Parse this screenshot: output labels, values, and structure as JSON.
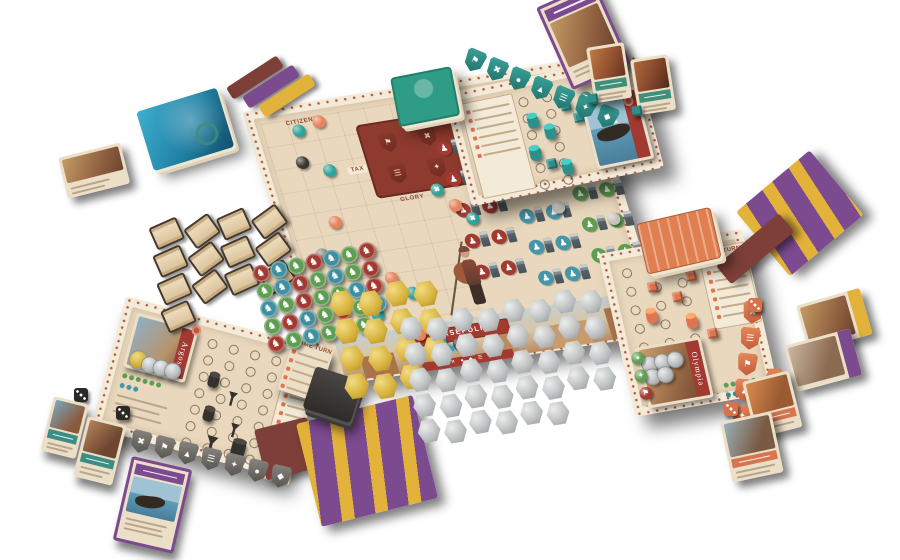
{
  "palette": {
    "bg": "#ffffff",
    "tan": "#e9d8bd",
    "frame": "#f3ead7",
    "motif": "#b0543a",
    "panel_red": "#8e3a2e",
    "red": "#a23a31",
    "blue": "#4596a8",
    "green": "#5f9e52",
    "teal": "#2f8f8a",
    "orange": "#e0764f",
    "dark": "#35312d",
    "gray": "#7e7a75",
    "silver": "#bcbfc0",
    "gold": "#d7b23c",
    "purple": "#7b4a8f",
    "yellow": "#e3b23a",
    "maroon": "#7d3f37",
    "parch": "#ecdfc8",
    "deck_green": "#2f9c85",
    "deck_blue": "#1f7fa3",
    "deck_orange": "#e08050",
    "deck_dark": "#3a3734",
    "ink": "#8a4a34",
    "line": "#c3ab8a",
    "ribbon": "#5d6b72"
  },
  "icons": {
    "horse": "♞",
    "award": "♟"
  },
  "main_board": {
    "labels": {
      "citizens": "CITIZENS",
      "tax": "TAX",
      "glory": "GLORY",
      "troops": "TROOPS"
    },
    "city": {
      "name": "PERSEPOLIS",
      "strip_icons": "✕ ● ◆ ☰",
      "slots": [
        {
          "c": "#a23a31"
        },
        {
          "c": "#4596a8"
        },
        {
          "c": "#5f9e52"
        }
      ]
    },
    "shield_panel": [
      {
        "g": "⚑"
      },
      {
        "g": "✖"
      },
      {
        "g": "▲"
      },
      {
        "g": "☰"
      },
      {
        "g": "✦"
      },
      {
        "g": "●"
      }
    ],
    "awards": {
      "red": {
        "cells": 12,
        "style": "--c:#a23a31"
      },
      "blue": {
        "cells": 12,
        "style": "--c:#4596a8"
      },
      "green": {
        "cells": 10,
        "style": "--c:#5f9e52"
      }
    },
    "track_tokens": [
      {
        "x": 34,
        "y": 12,
        "c": "#2fa39a"
      },
      {
        "x": 56,
        "y": 6,
        "c": "#e8825c"
      },
      {
        "x": 28,
        "y": 44,
        "c": "#3b3734"
      },
      {
        "x": 52,
        "y": 56,
        "c": "#2fa39a"
      },
      {
        "x": 42,
        "y": 108,
        "c": "#e8825c"
      },
      {
        "x": 20,
        "y": 138,
        "c": "#8e8a85"
      },
      {
        "x": 62,
        "y": 160,
        "c": "#3b3734"
      },
      {
        "x": 80,
        "y": 172,
        "c": "#e8825c"
      },
      {
        "x": 96,
        "y": 190,
        "c": "#2fa39a"
      },
      {
        "x": 56,
        "y": 206,
        "c": "#2fa39a"
      },
      {
        "x": 74,
        "y": 218,
        "c": "#3b3734"
      },
      {
        "x": 90,
        "y": 232,
        "c": "#e8825c"
      },
      {
        "x": 108,
        "y": 242,
        "c": "#2fa39a"
      },
      {
        "x": 126,
        "y": 248,
        "c": "#3b3734"
      },
      {
        "x": 150,
        "y": 92,
        "c": "#2fa39a",
        "g": "✖"
      },
      {
        "x": 163,
        "y": 110,
        "c": "#e8825c"
      },
      {
        "x": 176,
        "y": 126,
        "c": "#2fa39a",
        "g": "✖"
      },
      {
        "x": 255,
        "y": 52,
        "c": "#c7c2b8"
      },
      {
        "x": 305,
        "y": 82,
        "c": "#c7c2b8"
      },
      {
        "x": 262,
        "y": 128,
        "c": "#c7c2b8"
      },
      {
        "x": 312,
        "y": 148,
        "c": "#c7c2b8"
      }
    ]
  },
  "argos": {
    "title": "Argos",
    "panel_title": "GAME TURN",
    "panel_rows": 7,
    "ring_count": 28,
    "city_coins": {
      "gold": 1,
      "silver": 3
    },
    "shields": [
      {
        "g": "✖"
      },
      {
        "g": "⚑"
      },
      {
        "g": "▲"
      },
      {
        "g": "☰"
      },
      {
        "g": "✦"
      },
      {
        "g": "●"
      },
      {
        "g": "◆"
      }
    ]
  },
  "teal_player": {
    "panel_rows": 6,
    "ring_count": 12,
    "shields": [
      {
        "g": "⚑"
      },
      {
        "g": "✖"
      },
      {
        "g": "●"
      },
      {
        "g": "▲"
      },
      {
        "g": "☰"
      },
      {
        "g": "✦"
      },
      {
        "g": "◆"
      }
    ]
  },
  "olympia": {
    "title": "Olympia",
    "panel_title": "GAME TURN",
    "panel_rows": 7,
    "ring_count": 15,
    "city_coins": {
      "silver": 5
    },
    "shields": [
      {
        "g": "✖"
      },
      {
        "g": "☰"
      },
      {
        "g": "⚑"
      },
      {
        "g": "▲"
      },
      {
        "g": "✦"
      },
      {
        "g": "●"
      }
    ]
  },
  "reference_card": {
    "title": "GAME TURN",
    "rows": 5
  },
  "bank": {
    "gold_coins": 15,
    "silver_coins": 38,
    "scrolls": 13,
    "horse_tokens": [
      {
        "c": "#a23a31"
      },
      {
        "c": "#3e8fa0"
      },
      {
        "c": "#5f9e52"
      },
      {
        "c": "#a23a31"
      },
      {
        "c": "#3e8fa0"
      },
      {
        "c": "#5f9e52"
      },
      {
        "c": "#a23a31"
      },
      {
        "c": "#5f9e52"
      },
      {
        "c": "#3e8fa0"
      },
      {
        "c": "#a23a31"
      },
      {
        "c": "#5f9e52"
      },
      {
        "c": "#3e8fa0"
      },
      {
        "c": "#5f9e52"
      },
      {
        "c": "#a23a31"
      },
      {
        "c": "#3e8fa0"
      },
      {
        "c": "#5f9e52"
      },
      {
        "c": "#a23a31"
      },
      {
        "c": "#5f9e52"
      },
      {
        "c": "#5f9e52"
      },
      {
        "c": "#3e8fa0"
      },
      {
        "c": "#a23a31"
      },
      {
        "c": "#5f9e52"
      },
      {
        "c": "#a23a31"
      },
      {
        "c": "#3e8fa0"
      },
      {
        "c": "#5f9e52"
      },
      {
        "c": "#a23a31"
      },
      {
        "c": "#5f9e52"
      },
      {
        "c": "#3e8fa0"
      },
      {
        "c": "#a23a31"
      },
      {
        "c": "#5f9e52"
      },
      {
        "c": "#3e8fa0"
      },
      {
        "c": "#5f9e52"
      },
      {
        "c": "#a23a31"
      },
      {
        "c": "#5f9e52"
      }
    ]
  }
}
